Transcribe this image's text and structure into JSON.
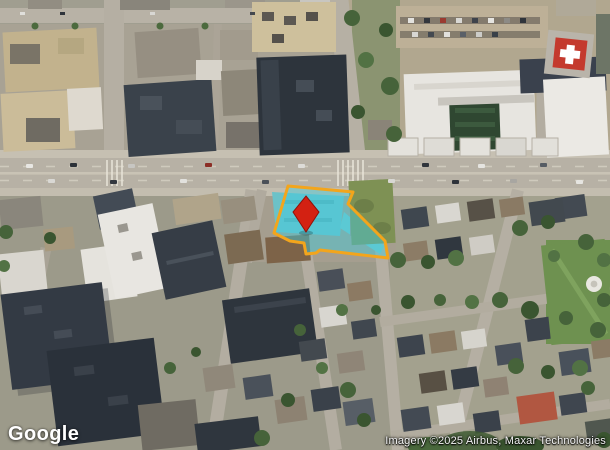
{
  "branding": {
    "logo_text": "Google"
  },
  "attribution": {
    "text": "Imagery ©2025 Airbus, Maxar Technologies"
  },
  "overlay": {
    "parcel": {
      "fill": "#3ecde1",
      "fill_opacity": "0.45",
      "outline": "#f3a51c"
    },
    "pin": {
      "fill": "#d32112",
      "stroke": "#911109"
    },
    "helipad": {
      "pad_fill": "#c43a2e",
      "cross_fill": "#ffffff"
    }
  }
}
